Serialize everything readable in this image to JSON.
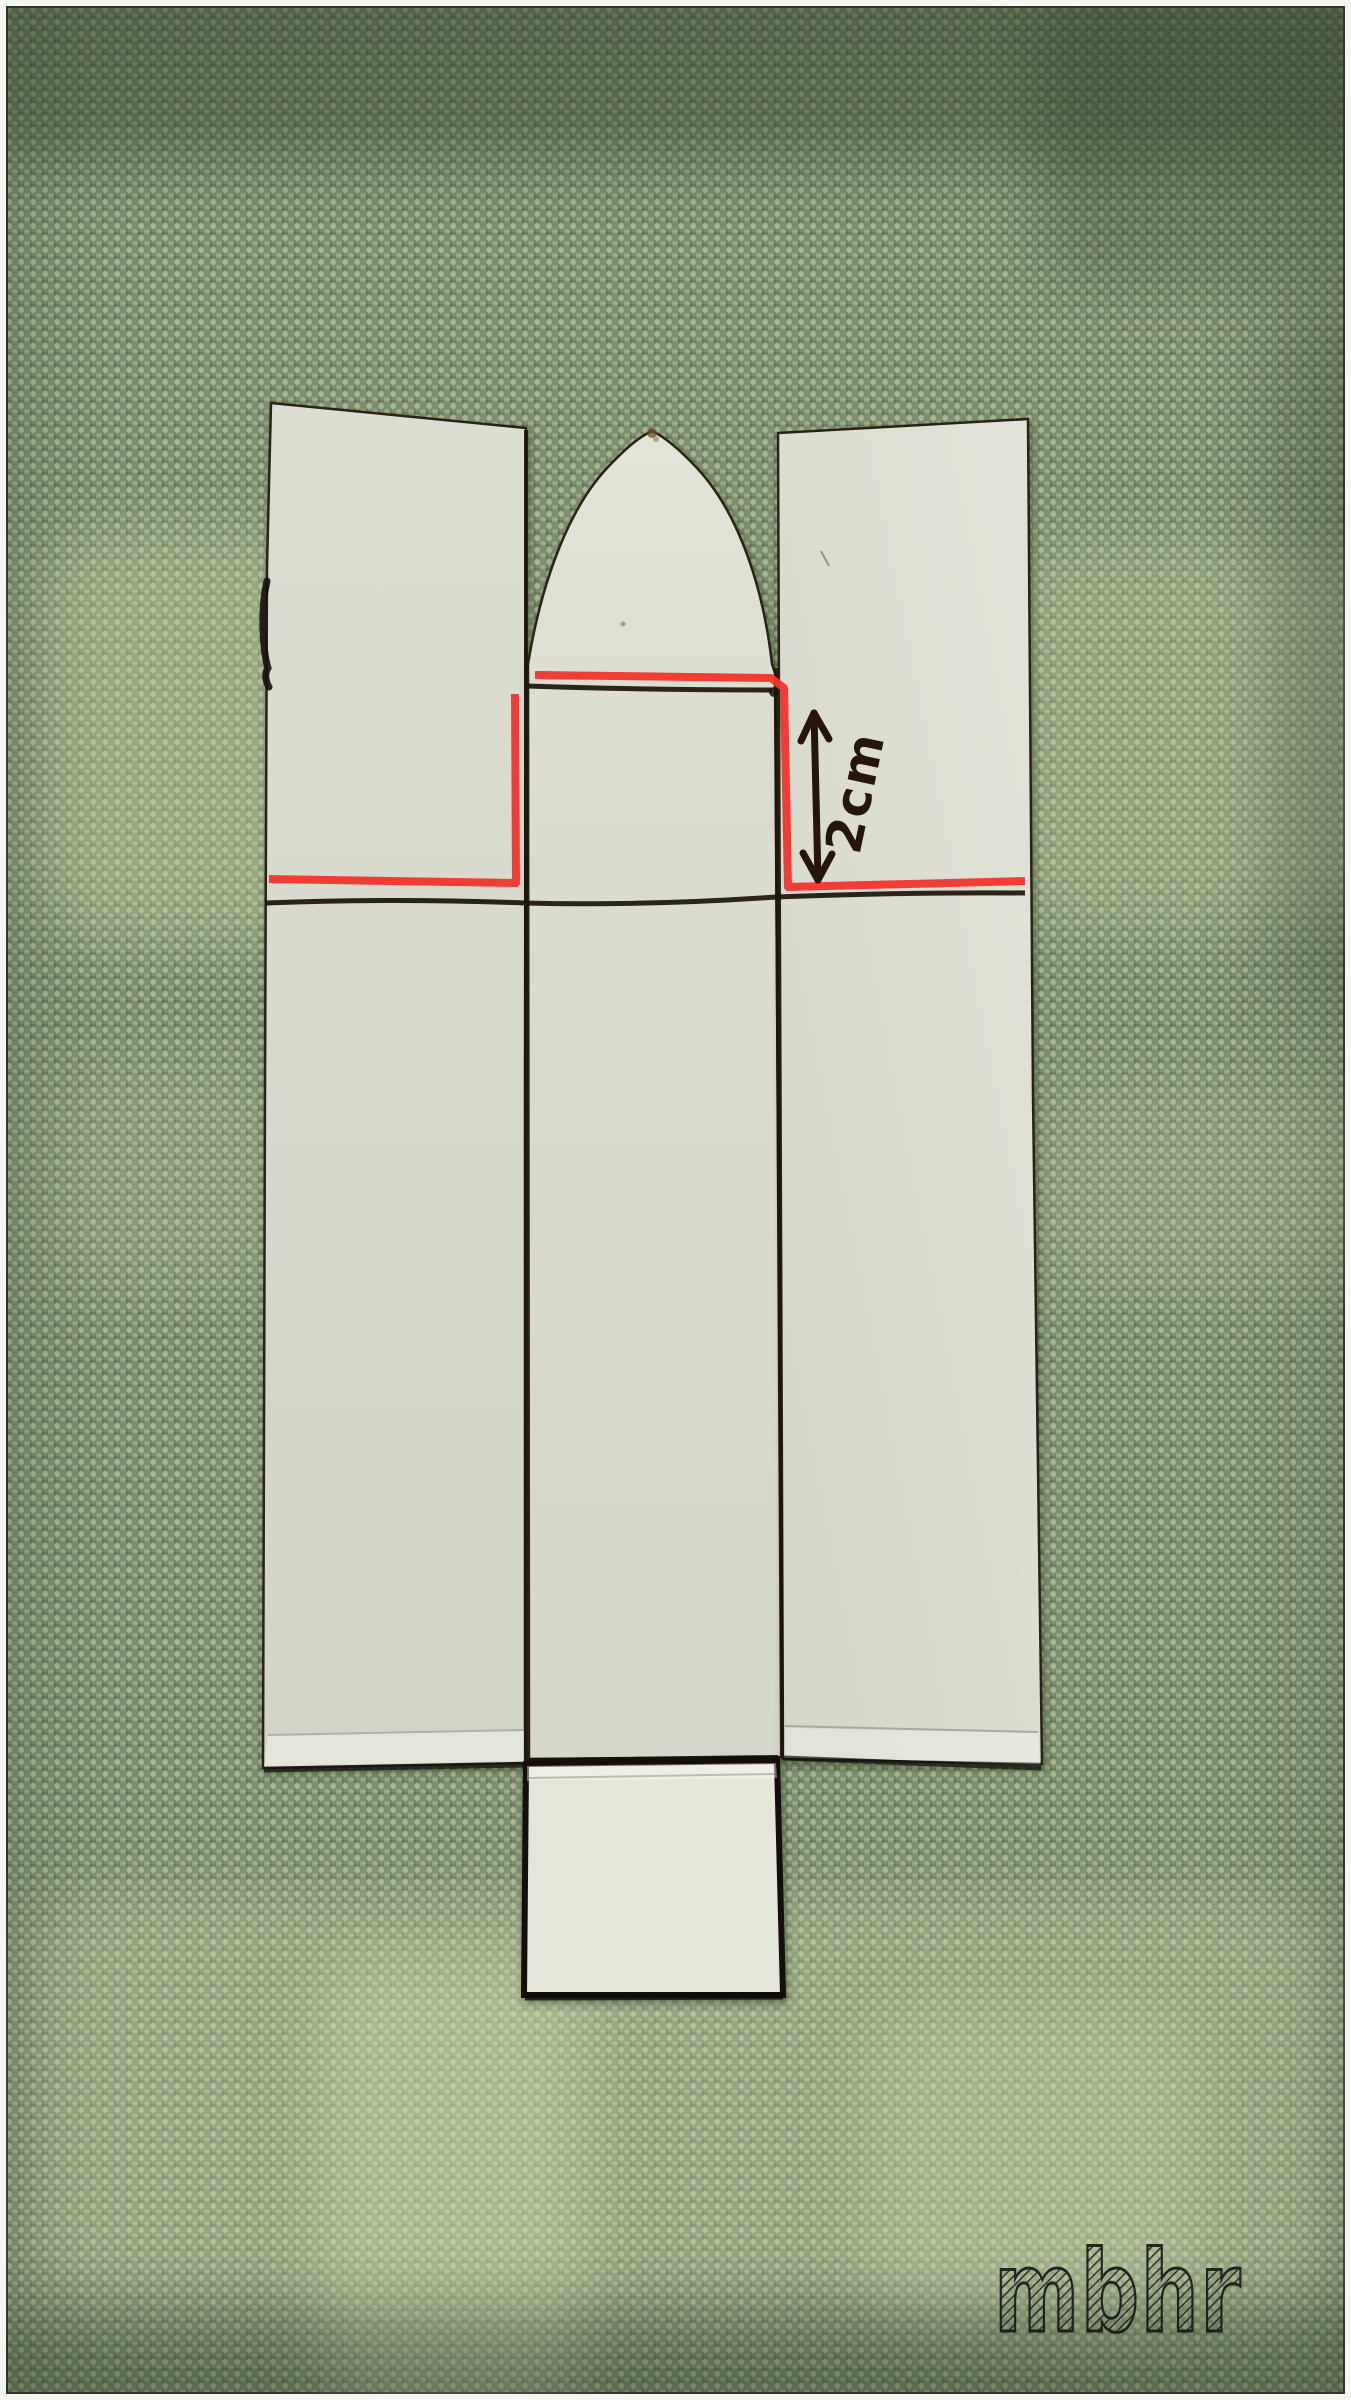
{
  "photo": {
    "description": "paper craft template photographed on green woven fabric",
    "fabric_base_color": "#7c8f6e",
    "fabric_weave_light": "#c8d4ac",
    "fabric_weave_dark": "#2e3e24",
    "paper_color": "#dcded2",
    "ink_color": "#1c130b",
    "cut_mark_color": "#f2342c"
  },
  "template": {
    "pieces": [
      "left-panel",
      "nose-cone",
      "center-column",
      "bottom-flap",
      "right-panel"
    ]
  },
  "annotation": {
    "dimension_label": "2cm"
  },
  "watermark": {
    "text": "mbhr"
  }
}
